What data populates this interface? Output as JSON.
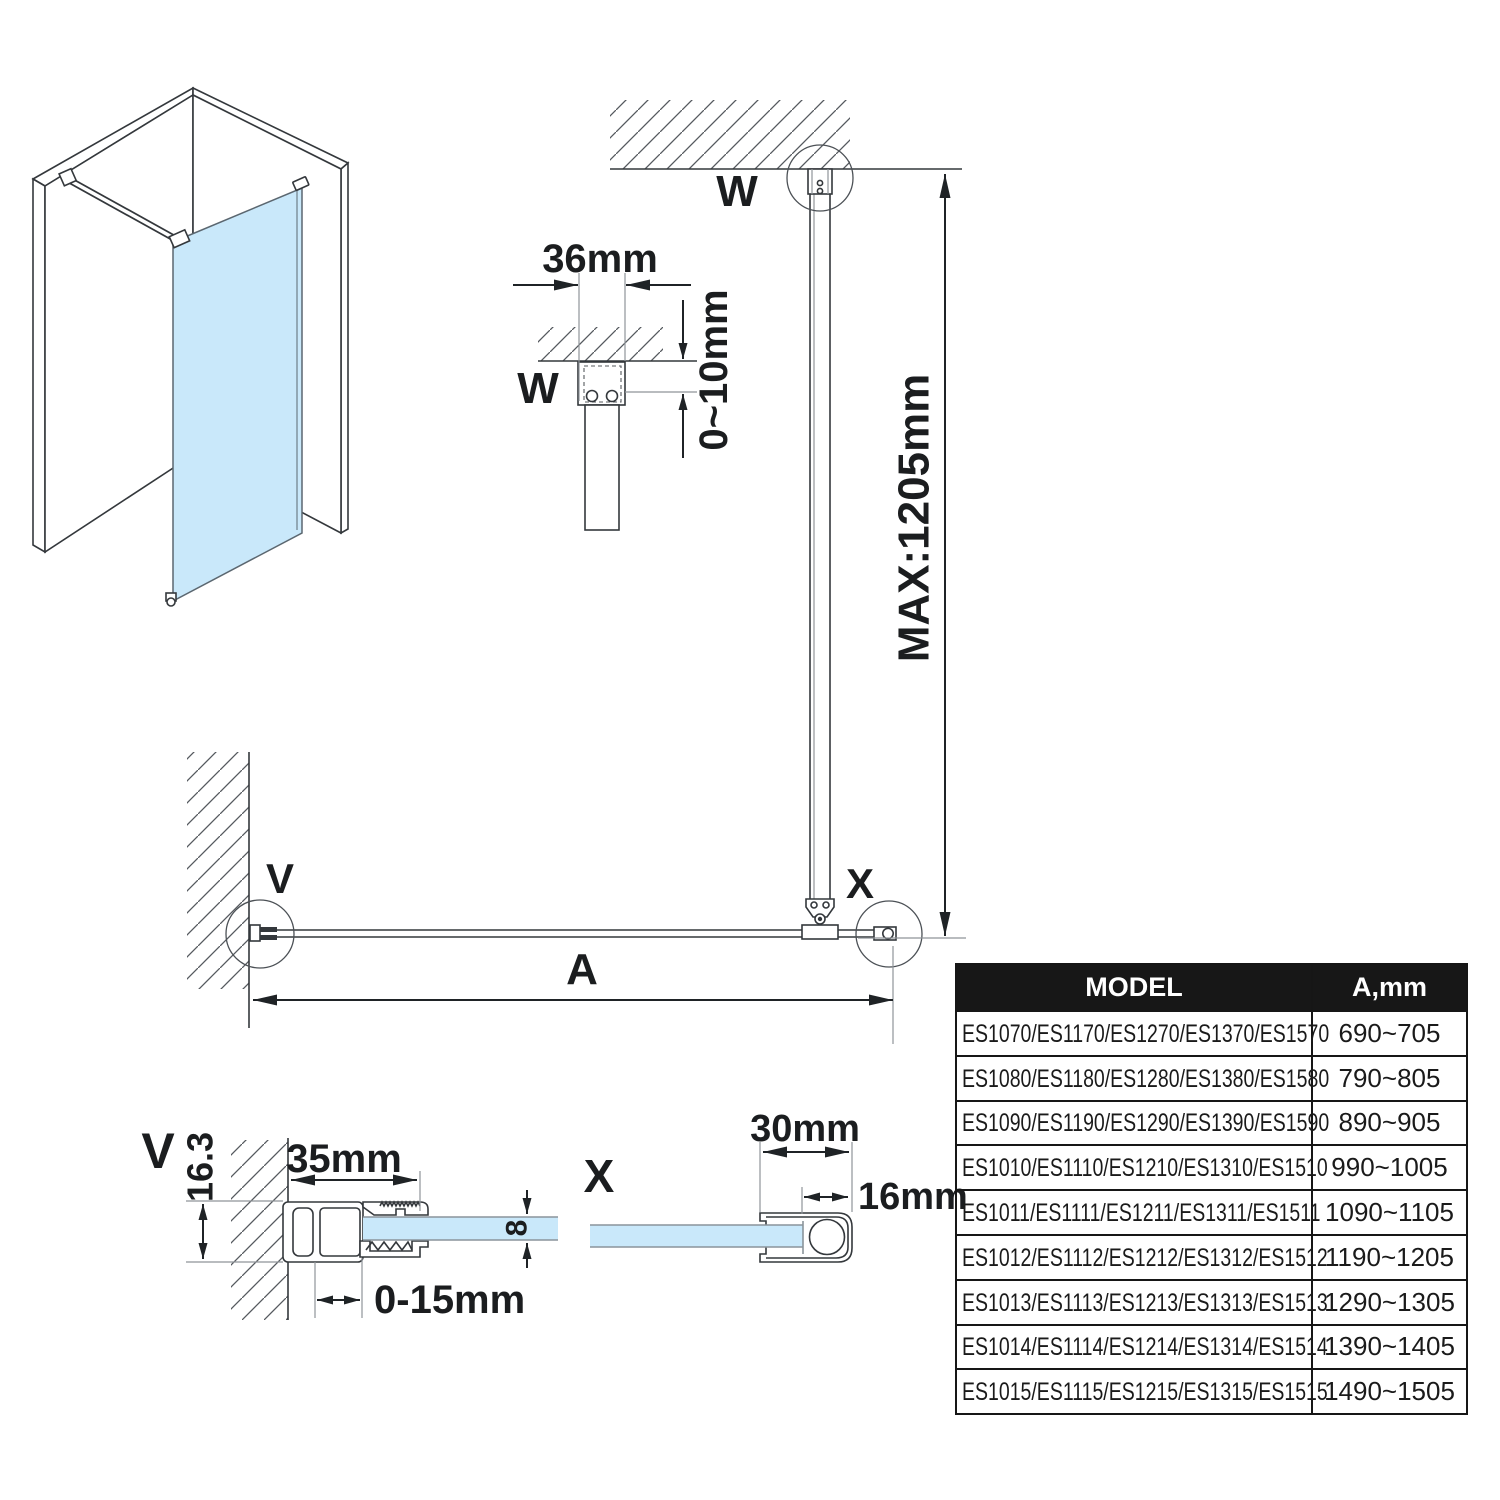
{
  "colors": {
    "glass": "#c9e8fa",
    "table_header_bg": "#171717",
    "line": "#34383c"
  },
  "diagram": {
    "detail_labels": {
      "w": "W",
      "v": "V",
      "x": "X"
    },
    "dimensions": {
      "max_height": "MAX:1205mm",
      "width_a": "A",
      "wall_bracket_width": "36mm",
      "ceiling_gap": "0~10mm",
      "wall_profile_width": "35mm",
      "wall_profile_depth": "16.3",
      "wall_profile_adjust": "0-15mm",
      "glass_thickness": "8",
      "support_profile_width": "30mm",
      "support_profile_depth": "16mm"
    }
  },
  "table": {
    "col_model": "MODEL",
    "col_a": "A,mm",
    "rows": [
      {
        "model": "ES1070/ES1170/ES1270/ES1370/ES1570",
        "a": "690~705"
      },
      {
        "model": "ES1080/ES1180/ES1280/ES1380/ES1580",
        "a": "790~805"
      },
      {
        "model": "ES1090/ES1190/ES1290/ES1390/ES1590",
        "a": "890~905"
      },
      {
        "model": "ES1010/ES1110/ES1210/ES1310/ES1510",
        "a": "990~1005"
      },
      {
        "model": "ES1011/ES1111/ES1211/ES1311/ES1511",
        "a": "1090~1105"
      },
      {
        "model": "ES1012/ES1112/ES1212/ES1312/ES1512",
        "a": "1190~1205"
      },
      {
        "model": "ES1013/ES1113/ES1213/ES1313/ES1513",
        "a": "1290~1305"
      },
      {
        "model": "ES1014/ES1114/ES1214/ES1314/ES1514",
        "a": "1390~1405"
      },
      {
        "model": "ES1015/ES1115/ES1215/ES1315/ES1515",
        "a": "1490~1505"
      }
    ]
  }
}
